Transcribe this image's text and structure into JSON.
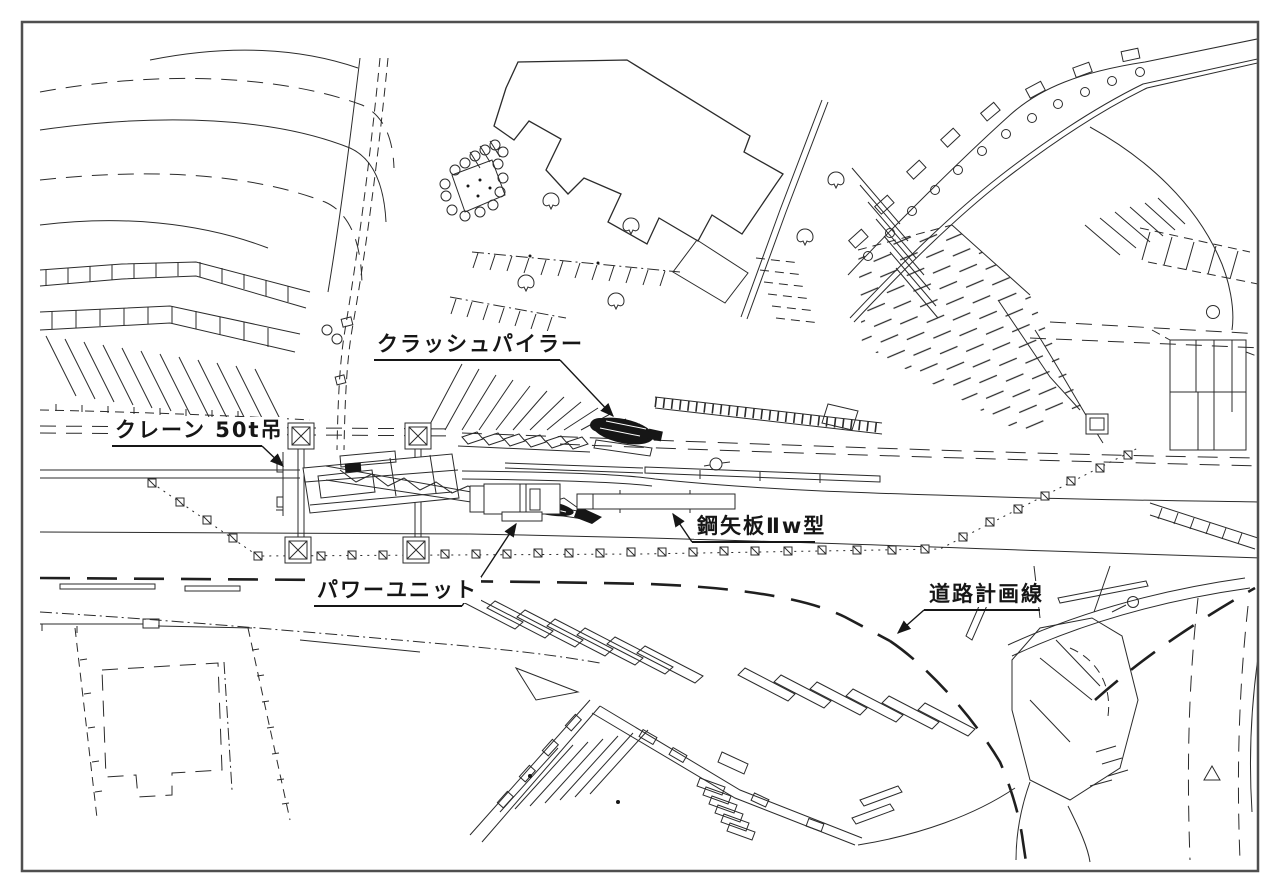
{
  "page": {
    "background": "#ffffff",
    "line_color": "#2b2b2b",
    "frame_color": "#4f4f4f",
    "machine_fill": "#161616",
    "drawing_type": "construction-site-plan"
  },
  "labels": {
    "crush_piler": "クラッシュパイラー",
    "crane": "クレーン 50t吊",
    "sheet_pile": "鋼矢板Ⅱw型",
    "power_unit": "パワーユニット",
    "road_plan_line": "道路計画線"
  }
}
